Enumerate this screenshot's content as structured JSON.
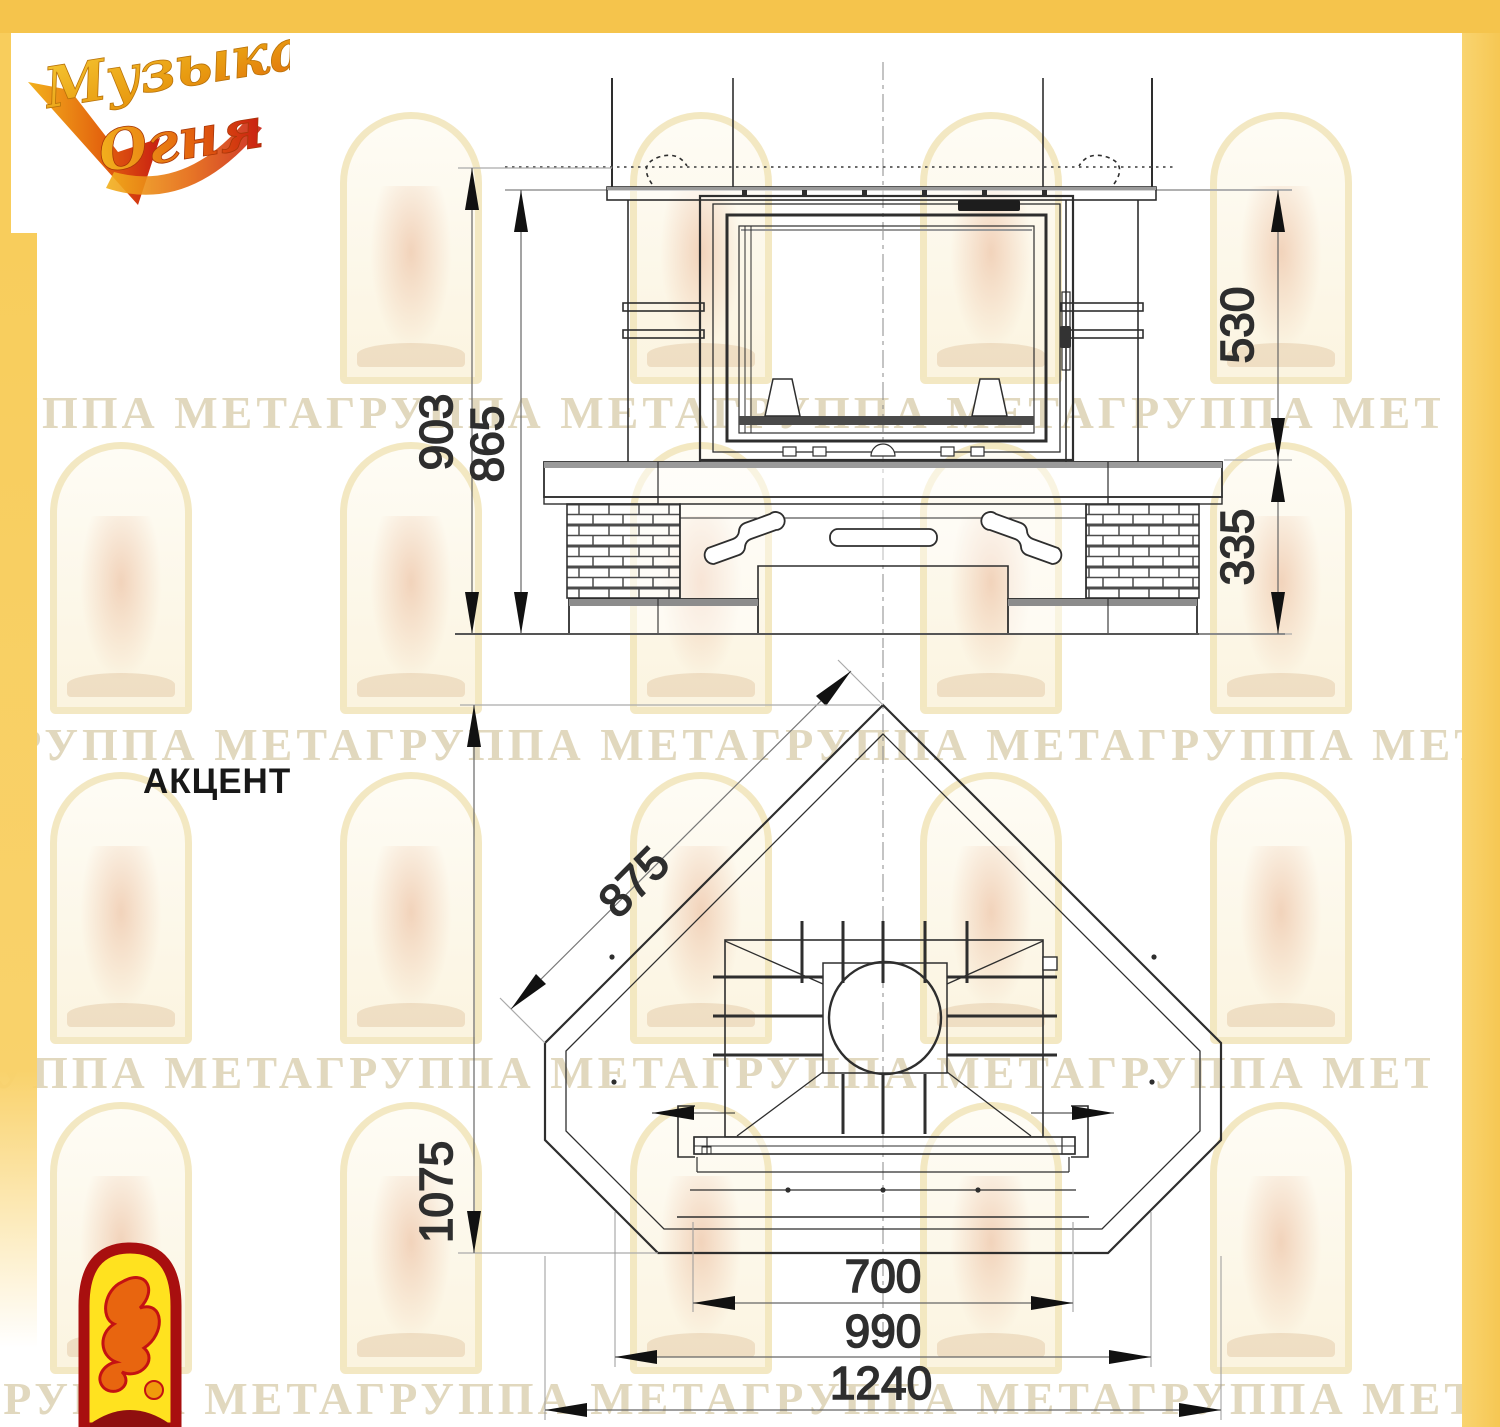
{
  "brand": {
    "line1": "Музыка",
    "line2": "Огня"
  },
  "model": {
    "name": "АКЦЕНТ"
  },
  "watermark": {
    "text": "ГРУППА МЕТАГРУППА МЕТАГРУППА МЕТАГРУППА МЕТАГРУППА МЕТА"
  },
  "colors": {
    "frame_yellow": "#f5c44c",
    "strip_yellow": "#f8cf63",
    "line_dark": "#2e2e2e",
    "logo_orange": "#e0570f",
    "logo_gold": "#e8a20c",
    "logo_red": "#c81e12"
  },
  "dimensions": {
    "front_view": {
      "overall_height": "903",
      "mantel_height": "865",
      "upper_section": "530",
      "base_section": "335"
    },
    "plan_view": {
      "face_width": "875",
      "depth": "1075",
      "opening_width": "700",
      "inner_width": "990",
      "overall_width": "1240"
    }
  }
}
